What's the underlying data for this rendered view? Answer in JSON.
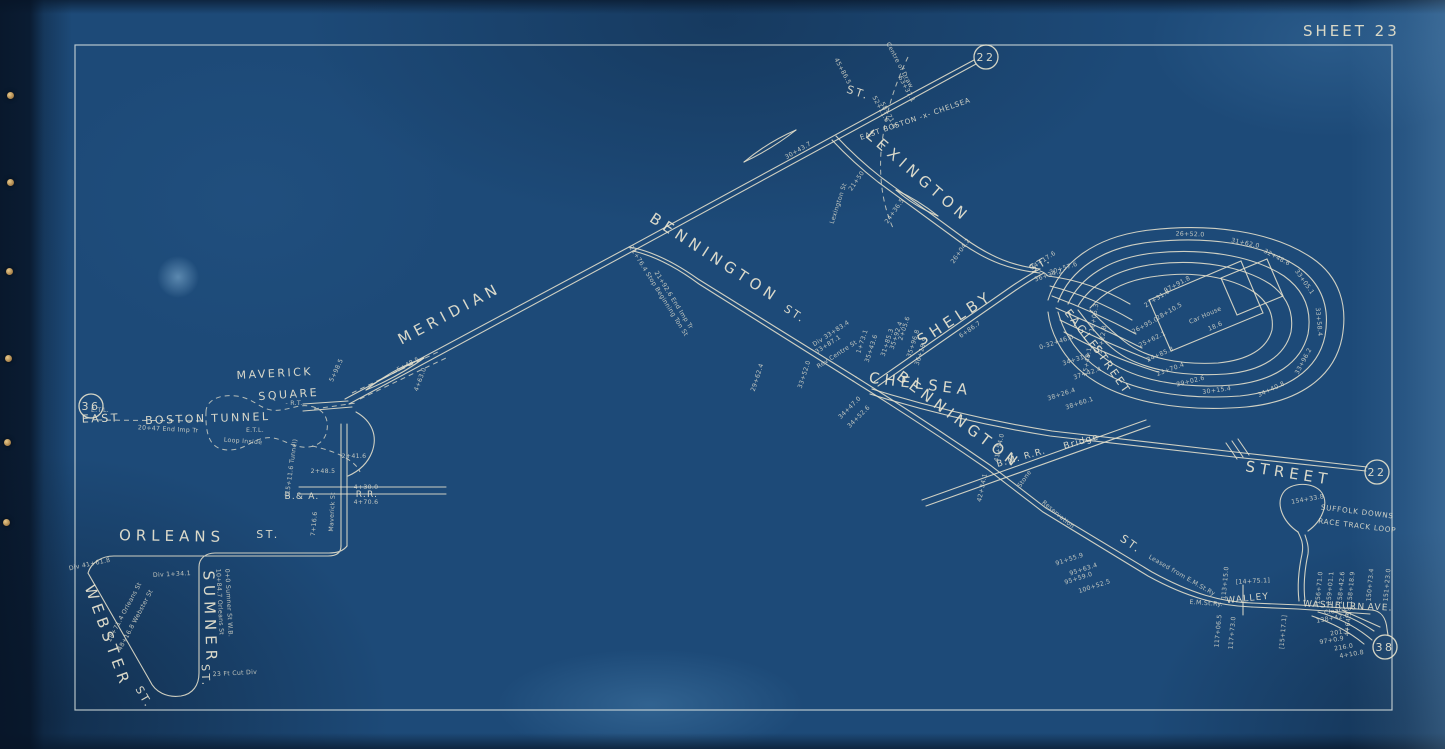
{
  "sheet": {
    "title": "SHEET 23"
  },
  "palette": {
    "paper": "#1d4a78",
    "paper_edge": "#0a1c30",
    "track_line": "#e8e3cd",
    "label_text": "#ebe6d2",
    "border_frame": "#dfe6e4",
    "fastener_pin": "#c99e5d"
  },
  "map": {
    "junction_circles": [
      {
        "label": "36",
        "x": 91,
        "y": 406
      },
      {
        "label": "22",
        "x": 986,
        "y": 57
      },
      {
        "label": "22",
        "x": 1377,
        "y": 472
      },
      {
        "label": "38",
        "x": 1385,
        "y": 647
      }
    ],
    "street_labels": [
      {
        "t": "MERIDIAN",
        "x": 452,
        "y": 318,
        "r": -28,
        "c": "xl"
      },
      {
        "t": "BENNINGTON",
        "x": 712,
        "y": 262,
        "r": 33,
        "c": "xl"
      },
      {
        "t": "ST.",
        "x": 793,
        "y": 317,
        "r": 33,
        "c": "lg"
      },
      {
        "t": "LEXINGTON",
        "x": 915,
        "y": 180,
        "r": 41,
        "c": "xl"
      },
      {
        "t": "ST.",
        "x": 857,
        "y": 96,
        "r": 18,
        "c": "lg"
      },
      {
        "t": "CHELSEA",
        "x": 920,
        "y": 389,
        "r": 7,
        "c": "xl"
      },
      {
        "t": "STREET",
        "x": 1288,
        "y": 478,
        "r": 9,
        "c": "xl"
      },
      {
        "t": "BENNINGTON",
        "x": 956,
        "y": 424,
        "r": 37,
        "c": "xl"
      },
      {
        "t": "ST.",
        "x": 1129,
        "y": 547,
        "r": 35,
        "c": "lg"
      },
      {
        "t": "SHELBY",
        "x": 958,
        "y": 322,
        "r": -33,
        "c": "xl"
      },
      {
        "t": "ST.",
        "x": 1042,
        "y": 267,
        "r": -30,
        "c": "lg"
      },
      {
        "t": "EAGLE",
        "x": 1079,
        "y": 332,
        "r": 52,
        "c": "lg"
      },
      {
        "t": "STREET",
        "x": 1109,
        "y": 372,
        "r": 55,
        "c": "lg"
      },
      {
        "t": "MAVERICK",
        "x": 275,
        "y": 377,
        "r": -3,
        "c": "lg"
      },
      {
        "t": "SQUARE",
        "x": 289,
        "y": 398,
        "r": -4,
        "c": "lg"
      },
      {
        "t": "EAST",
        "x": 101,
        "y": 422,
        "r": -2,
        "c": "lg"
      },
      {
        "t": "BOSTON",
        "x": 176,
        "y": 423,
        "r": -2,
        "c": "lg"
      },
      {
        "t": "TUNNEL",
        "x": 241,
        "y": 421,
        "r": -2,
        "c": "lg"
      },
      {
        "t": "ORLEANS",
        "x": 172,
        "y": 541,
        "r": 1,
        "c": "xl"
      },
      {
        "t": "ST.",
        "x": 268,
        "y": 538,
        "r": 0,
        "c": "lg"
      },
      {
        "t": "SUMNER",
        "x": 205,
        "y": 618,
        "r": 88,
        "c": "xl"
      },
      {
        "t": "ST.",
        "x": 202,
        "y": 676,
        "r": 88,
        "c": "lg"
      },
      {
        "t": "WEBSTER",
        "x": 103,
        "y": 638,
        "r": 70,
        "c": "xl"
      },
      {
        "t": "ST.",
        "x": 141,
        "y": 699,
        "r": 60,
        "c": "lg"
      },
      {
        "t": "WALLEY",
        "x": 1248,
        "y": 601,
        "r": -6,
        "c": "md"
      },
      {
        "t": "WASHBURN",
        "x": 1334,
        "y": 608,
        "r": 3,
        "c": "md"
      },
      {
        "t": "AVE.",
        "x": 1380,
        "y": 610,
        "r": 3,
        "c": "md"
      },
      {
        "t": "B.& A.",
        "x": 302,
        "y": 499,
        "r": 0,
        "c": "md"
      },
      {
        "t": "R.R.",
        "x": 367,
        "y": 497,
        "r": 0,
        "c": "md"
      },
      {
        "t": "B.M. R.R.",
        "x": 1022,
        "y": 460,
        "r": -16,
        "c": "md"
      },
      {
        "t": "Bridge",
        "x": 1082,
        "y": 444,
        "r": -16,
        "c": "md"
      }
    ],
    "annotations": [
      {
        "t": "EAST BOSTON -x- CHELSEA",
        "x": 916,
        "y": 121,
        "r": -19,
        "c": "sm"
      },
      {
        "t": "SUFFOLK DOWNS",
        "x": 1357,
        "y": 514,
        "r": 7,
        "c": "sm"
      },
      {
        "t": "RACE TRACK LOOP",
        "x": 1357,
        "y": 528,
        "r": 7,
        "c": "sm"
      },
      {
        "t": "Centre of Draw",
        "x": 898,
        "y": 66,
        "r": 62
      },
      {
        "t": "52+11.6",
        "x": 879,
        "y": 110,
        "r": 62
      },
      {
        "t": "63+37.1",
        "x": 905,
        "y": 90,
        "r": 62
      },
      {
        "t": "45+86.5",
        "x": 841,
        "y": 72,
        "r": 62
      },
      {
        "t": "58+71.8",
        "x": 887,
        "y": 116,
        "r": 62
      },
      {
        "t": "30+43.7",
        "x": 799,
        "y": 152,
        "r": -30
      },
      {
        "t": "Lexington St",
        "x": 840,
        "y": 204,
        "r": -72
      },
      {
        "t": "21+50",
        "x": 858,
        "y": 182,
        "r": -55
      },
      {
        "t": "24+36.5",
        "x": 896,
        "y": 212,
        "r": -55
      },
      {
        "t": "26+04.2",
        "x": 962,
        "y": 252,
        "r": -55
      },
      {
        "t": "21+76.4  Stop Beginning Ton St",
        "x": 657,
        "y": 292,
        "r": 58
      },
      {
        "t": "21+92.6  End Imp Tr",
        "x": 672,
        "y": 301,
        "r": 58
      },
      {
        "t": "5+48.5",
        "x": 409,
        "y": 366,
        "r": -28
      },
      {
        "t": "4+63.0",
        "x": 422,
        "y": 380,
        "r": -70
      },
      {
        "t": "5+98.5",
        "x": 338,
        "y": 371,
        "r": -65
      },
      {
        "t": "- R.T.",
        "x": 294,
        "y": 405,
        "r": 0
      },
      {
        "t": "E.T.L.",
        "x": 255,
        "y": 432,
        "r": 0
      },
      {
        "t": "E.T.L.",
        "x": 100,
        "y": 412,
        "r": 0
      },
      {
        "t": "Loop Inside",
        "x": 243,
        "y": 443,
        "r": 4
      },
      {
        "t": "20+47  End Imp Tr",
        "x": 168,
        "y": 431,
        "r": 3
      },
      {
        "t": "(15+11.6 Tunnel)",
        "x": 293,
        "y": 468,
        "r": -82
      },
      {
        "t": "2+41.6",
        "x": 354,
        "y": 458,
        "r": 0
      },
      {
        "t": "2+48.5",
        "x": 323,
        "y": 473,
        "r": 0
      },
      {
        "t": "7+16.6",
        "x": 316,
        "y": 524,
        "r": -85
      },
      {
        "t": "Maverick St",
        "x": 334,
        "y": 512,
        "r": -87
      },
      {
        "t": "4+30.0",
        "x": 366,
        "y": 489,
        "r": 0
      },
      {
        "t": "4+70.6",
        "x": 366,
        "y": 504,
        "r": 0
      },
      {
        "t": "Div 41+61.8",
        "x": 90,
        "y": 566,
        "r": -12
      },
      {
        "t": "Div 1+34.1",
        "x": 172,
        "y": 576,
        "r": -3
      },
      {
        "t": "18+71.4 Orleans St",
        "x": 126,
        "y": 613,
        "r": -62
      },
      {
        "t": "48+16.8 Webster St",
        "x": 137,
        "y": 621,
        "r": -62
      },
      {
        "t": "10+84.7 Orleans St",
        "x": 218,
        "y": 602,
        "r": 87
      },
      {
        "t": "0+0 Sumner St W.B.",
        "x": 227,
        "y": 603,
        "r": 87
      },
      {
        "t": "23 Ft Cut Div",
        "x": 235,
        "y": 675,
        "r": -3
      },
      {
        "t": "Div 33+83.4",
        "x": 832,
        "y": 335,
        "r": -33
      },
      {
        "t": "33+87.1",
        "x": 829,
        "y": 346,
        "r": -33
      },
      {
        "t": "Rev Centre St",
        "x": 838,
        "y": 356,
        "r": -33
      },
      {
        "t": "33+52.0",
        "x": 806,
        "y": 375,
        "r": -72
      },
      {
        "t": "29+62.4",
        "x": 759,
        "y": 378,
        "r": -72
      },
      {
        "t": "34+47.0",
        "x": 851,
        "y": 409,
        "r": -45
      },
      {
        "t": "34+52.6",
        "x": 860,
        "y": 418,
        "r": -45
      },
      {
        "t": "1+73.1",
        "x": 864,
        "y": 342,
        "r": -72
      },
      {
        "t": "35+43.6",
        "x": 873,
        "y": 349,
        "r": -72
      },
      {
        "t": "31+85.3",
        "x": 889,
        "y": 343,
        "r": -72
      },
      {
        "t": "35+92.4",
        "x": 898,
        "y": 336,
        "r": -72
      },
      {
        "t": "2+05.6",
        "x": 906,
        "y": 329,
        "r": -72
      },
      {
        "t": "35+96.8",
        "x": 915,
        "y": 344,
        "r": -72
      },
      {
        "t": "36+18.5",
        "x": 923,
        "y": 352,
        "r": -72
      },
      {
        "t": "6+86.7",
        "x": 971,
        "y": 331,
        "r": -35
      },
      {
        "t": "34+17.6",
        "x": 1044,
        "y": 262,
        "r": -33
      },
      {
        "t": "30+57.6",
        "x": 1064,
        "y": 270,
        "r": -18
      },
      {
        "t": "36+34.2",
        "x": 1049,
        "y": 277,
        "r": -18
      },
      {
        "t": "0-32+46.0",
        "x": 1057,
        "y": 344,
        "r": -18
      },
      {
        "t": "34+31.4",
        "x": 1077,
        "y": 361,
        "r": -18
      },
      {
        "t": "37+42.4",
        "x": 1088,
        "y": 375,
        "r": -18
      },
      {
        "t": "38+26.4",
        "x": 1062,
        "y": 396,
        "r": -18
      },
      {
        "t": "38+60.1",
        "x": 1080,
        "y": 405,
        "r": -18
      },
      {
        "t": "15+48.1",
        "x": 1089,
        "y": 362,
        "r": -80
      },
      {
        "t": "Car House",
        "x": 1206,
        "y": 317,
        "r": -24
      },
      {
        "t": "18.6",
        "x": 1216,
        "y": 328,
        "r": -24
      },
      {
        "t": "97+91.8",
        "x": 1178,
        "y": 286,
        "r": -28
      },
      {
        "t": "27+31.6",
        "x": 1158,
        "y": 300,
        "r": -32
      },
      {
        "t": "28+10.5",
        "x": 1170,
        "y": 313,
        "r": -30
      },
      {
        "t": "26+95.0",
        "x": 1146,
        "y": 327,
        "r": -28
      },
      {
        "t": "25+62.1",
        "x": 1153,
        "y": 341,
        "r": -26
      },
      {
        "t": "24+85.3",
        "x": 1161,
        "y": 356,
        "r": -24
      },
      {
        "t": "23+70.4",
        "x": 1171,
        "y": 371,
        "r": -20
      },
      {
        "t": "29+02.6",
        "x": 1191,
        "y": 383,
        "r": -14
      },
      {
        "t": "30+15.4",
        "x": 1217,
        "y": 392,
        "r": -8
      },
      {
        "t": "26+52.0",
        "x": 1190,
        "y": 236,
        "r": 2
      },
      {
        "t": "31+62.0",
        "x": 1245,
        "y": 245,
        "r": 12
      },
      {
        "t": "32+48.6",
        "x": 1276,
        "y": 259,
        "r": 28
      },
      {
        "t": "33+05.1",
        "x": 1303,
        "y": 283,
        "r": 55
      },
      {
        "t": "33+58.4",
        "x": 1317,
        "y": 322,
        "r": 85
      },
      {
        "t": "33+96.2",
        "x": 1305,
        "y": 362,
        "r": -62
      },
      {
        "t": "34+40.8",
        "x": 1272,
        "y": 391,
        "r": -25
      },
      {
        "t": "16+05.3",
        "x": 1096,
        "y": 318,
        "r": -80
      },
      {
        "t": "17+22.8",
        "x": 1104,
        "y": 340,
        "r": -80
      },
      {
        "t": "42+34.1",
        "x": 984,
        "y": 488,
        "r": -78
      },
      {
        "t": "41+54.0",
        "x": 1001,
        "y": 448,
        "r": -78
      },
      {
        "t": "Stone",
        "x": 1026,
        "y": 480,
        "r": -55
      },
      {
        "t": "Reservation",
        "x": 1057,
        "y": 516,
        "r": 40
      },
      {
        "t": "91+55.9",
        "x": 1070,
        "y": 561,
        "r": -18
      },
      {
        "t": "95+63.4",
        "x": 1084,
        "y": 571,
        "r": -18
      },
      {
        "t": "95+59.0",
        "x": 1079,
        "y": 580,
        "r": -18
      },
      {
        "t": "100+52.5",
        "x": 1095,
        "y": 588,
        "r": -18
      },
      {
        "t": "Leased from E.M.St.Ry",
        "x": 1181,
        "y": 577,
        "r": 30
      },
      {
        "t": "E.M.St.Ry.",
        "x": 1206,
        "y": 605,
        "r": 4
      },
      {
        "t": "154+33.8",
        "x": 1308,
        "y": 501,
        "r": -10
      },
      {
        "t": "[14+75.1]",
        "x": 1253,
        "y": 583,
        "r": -3
      },
      {
        "t": "113+15.0",
        "x": 1227,
        "y": 583,
        "r": -85
      },
      {
        "t": "156+71.0",
        "x": 1321,
        "y": 588,
        "r": -85
      },
      {
        "t": "159+01.1",
        "x": 1332,
        "y": 588,
        "r": -85
      },
      {
        "t": "158+42.6",
        "x": 1343,
        "y": 588,
        "r": -85
      },
      {
        "t": "158+18.9",
        "x": 1353,
        "y": 588,
        "r": -85
      },
      {
        "t": "150+73.4",
        "x": 1372,
        "y": 585,
        "r": -85
      },
      {
        "t": "151+23.0",
        "x": 1389,
        "y": 585,
        "r": -85
      },
      {
        "t": "117+06.5",
        "x": 1220,
        "y": 631,
        "r": -85
      },
      {
        "t": "117+73.0",
        "x": 1234,
        "y": 633,
        "r": -85
      },
      {
        "t": "[15+17.1]",
        "x": 1285,
        "y": 632,
        "r": -85
      },
      {
        "t": "4+64.5",
        "x": 1350,
        "y": 624,
        "r": -85
      },
      {
        "t": "Clear Loc",
        "x": 1340,
        "y": 612,
        "r": -10
      },
      {
        "t": "138+42.0",
        "x": 1333,
        "y": 620,
        "r": -10
      },
      {
        "t": "201.7",
        "x": 1340,
        "y": 634,
        "r": -10
      },
      {
        "t": "97+0.9",
        "x": 1332,
        "y": 642,
        "r": -10
      },
      {
        "t": "216.0",
        "x": 1344,
        "y": 649,
        "r": -10
      },
      {
        "t": "4+10.8",
        "x": 1352,
        "y": 656,
        "r": -10
      }
    ]
  }
}
